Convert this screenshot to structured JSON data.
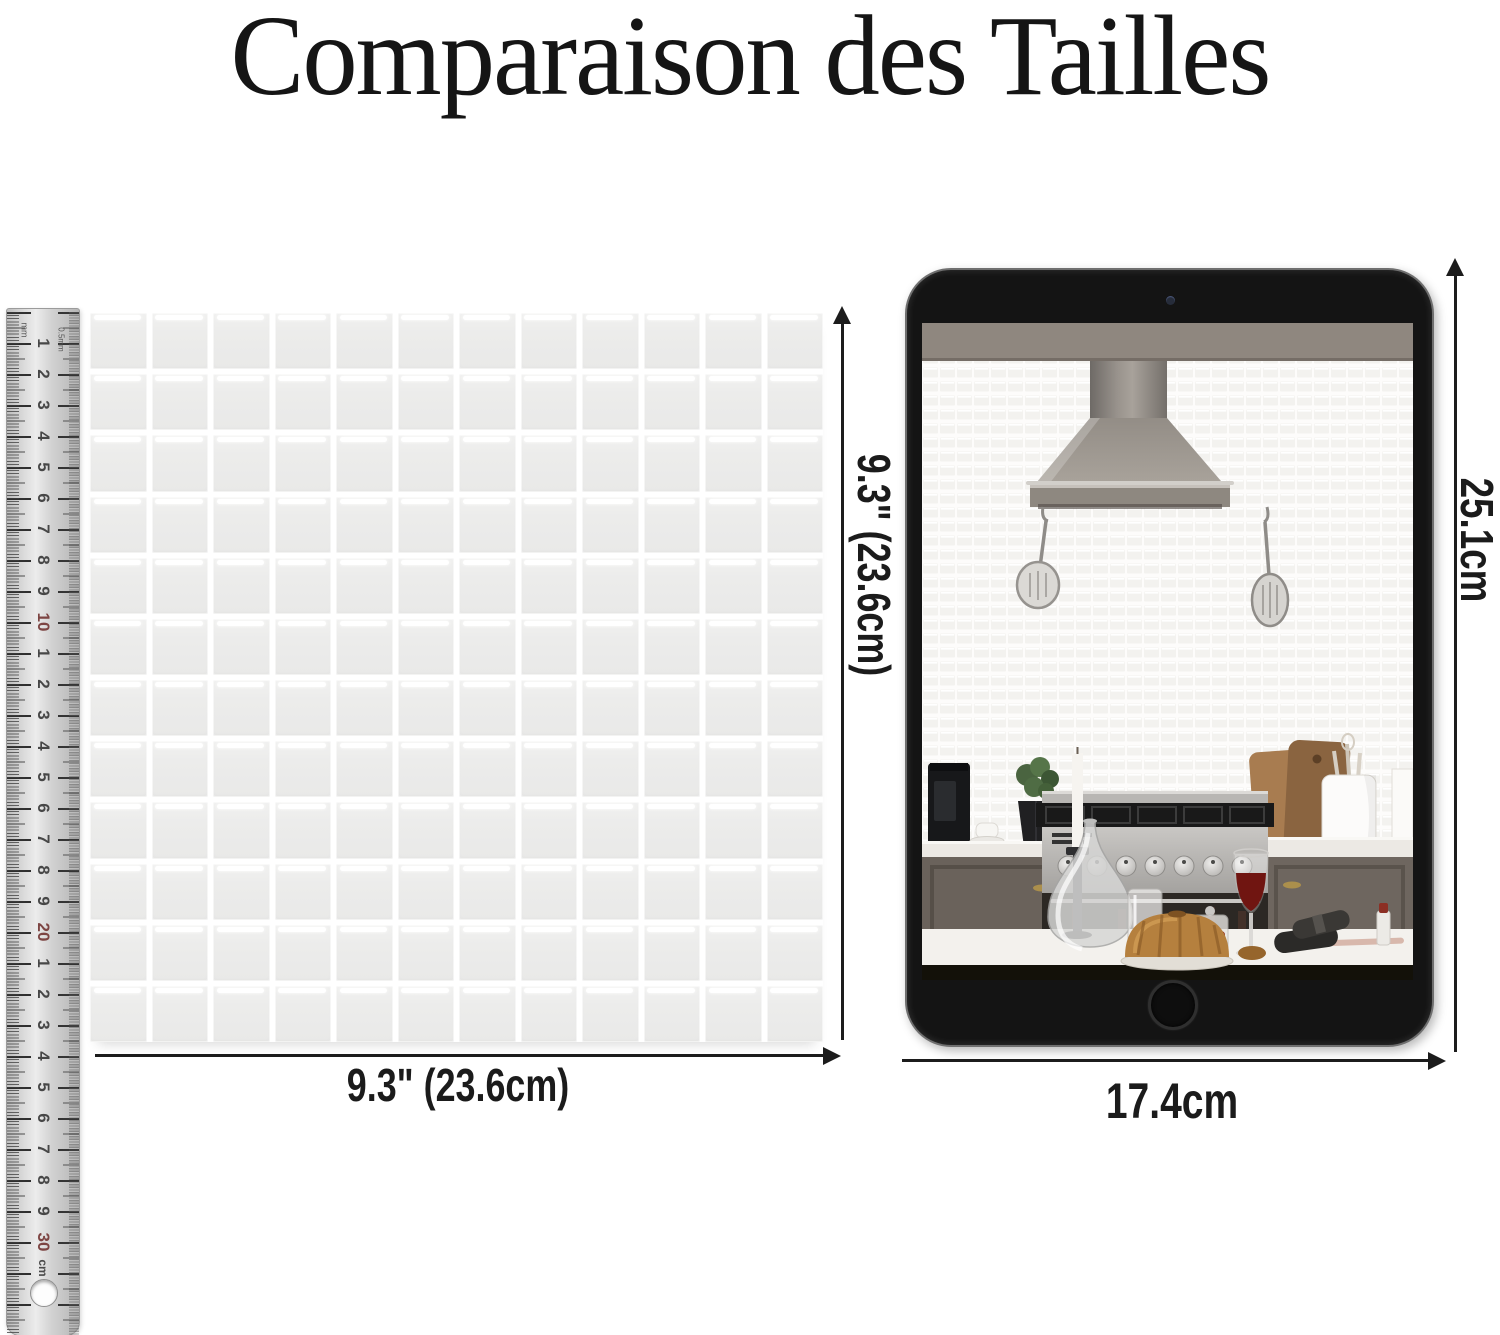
{
  "title": "Comparaison des Tailles",
  "ruler": {
    "top_label_left": "mm",
    "top_label_right": "0.5mm",
    "numbers": [
      "1",
      "2",
      "3",
      "4",
      "5",
      "6",
      "7",
      "8",
      "9",
      "10",
      "1",
      "2",
      "3",
      "4",
      "5",
      "6",
      "7",
      "8",
      "9",
      "20",
      "1",
      "2",
      "3",
      "4",
      "5",
      "6",
      "7",
      "8",
      "9",
      "30"
    ],
    "unit_suffix": "cm",
    "number_color": "#474747",
    "tens_color": "#7d4543"
  },
  "tile_sheet": {
    "columns": 12,
    "rows": 12,
    "tile_color": "#ececeb",
    "highlight_color": "#ffffff",
    "width_label": "9.3\" (23.6cm)",
    "height_label": "9.3\" (23.6cm)"
  },
  "tablet": {
    "height_label": "25.1cm",
    "width_label": "17.4cm",
    "bezel_color": "#141414",
    "screen_scene": "kitchen with range hood, white mosaic backsplash, stove and decorated counter"
  },
  "arrow_color": "#1c1c1c",
  "background_color": "#ffffff"
}
